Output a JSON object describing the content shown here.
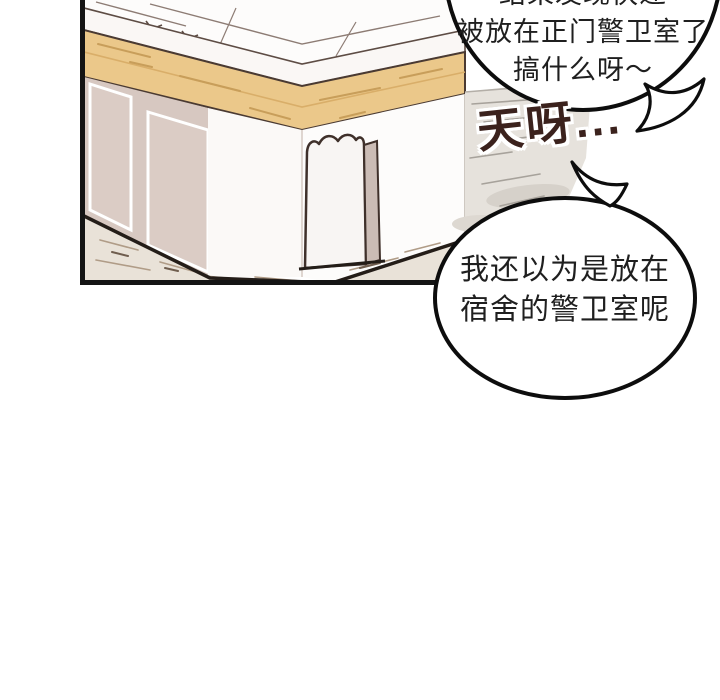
{
  "comic": {
    "bubble_top": {
      "line1": "结果发现快递",
      "line2": "被放在正门警卫室了",
      "line3": "搞什么呀～"
    },
    "exclamation": "天呀...",
    "bubble_bottom": {
      "line1": "我还以为是放在",
      "line2": "宿舍的警卫室呢"
    },
    "colors": {
      "panel_border": "#141414",
      "bubble_outline": "#0d0d0d",
      "speech_text": "#1f1f1f",
      "exclamation_text": "#3b221d",
      "wood_band": "#ebc88a",
      "wall_mauve": "#d7c8c1",
      "roof_white": "#fdfcfb",
      "pavement": "#e9e2d8"
    }
  }
}
